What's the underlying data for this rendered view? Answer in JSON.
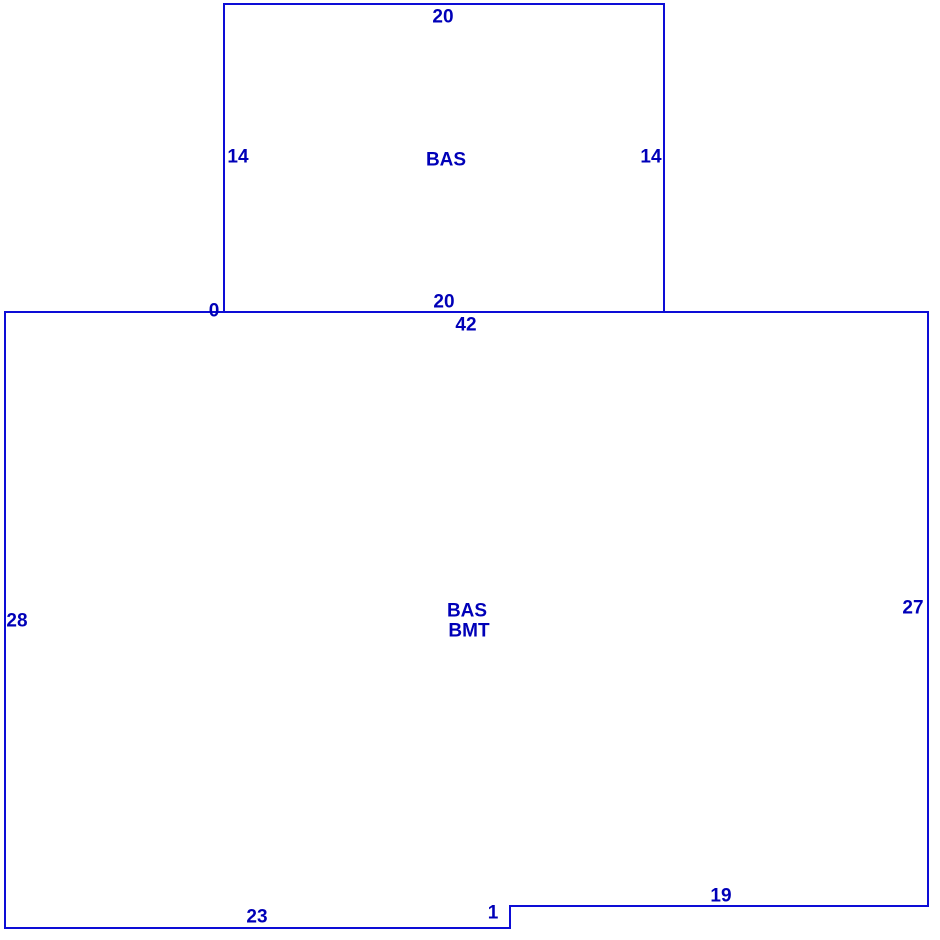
{
  "colors": {
    "line": "#0d0dd6",
    "text": "#0000b8",
    "background": "#ffffff"
  },
  "sketch": {
    "junction_label": "0",
    "upper_area": {
      "label": "BAS",
      "dimensions": {
        "top": "20",
        "left": "14",
        "right": "14",
        "bottom": "20"
      }
    },
    "lower_area": {
      "label_line1": "BAS",
      "label_line2": "BMT",
      "dimensions": {
        "top": "42",
        "left": "28",
        "right": "27",
        "bottom_right": "19",
        "step": "1",
        "bottom_left": "23"
      }
    }
  }
}
